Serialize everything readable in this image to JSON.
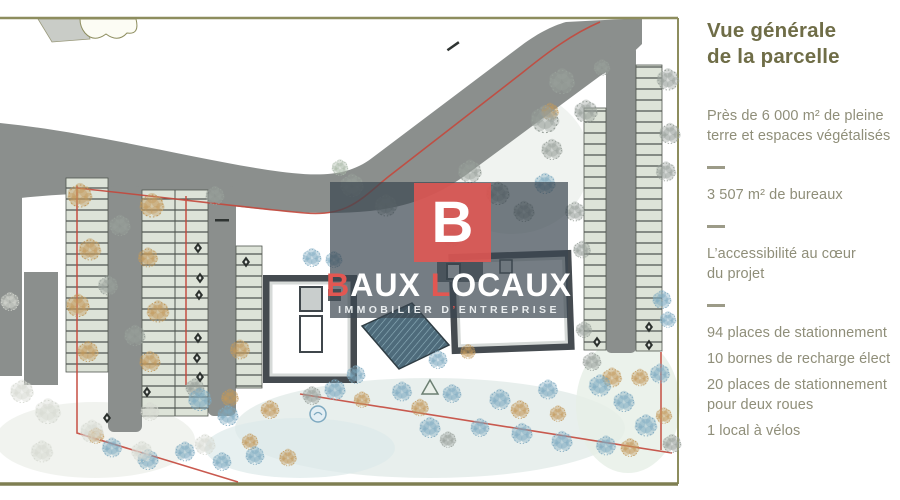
{
  "panel": {
    "title": "Vue générale\nde la parcelle",
    "items": [
      {
        "type": "text",
        "text": "Près de 6 000 m² de pleine\nterre et espaces végétalisés"
      },
      {
        "type": "divider"
      },
      {
        "type": "text",
        "text": "3 507 m² de bureaux"
      },
      {
        "type": "divider"
      },
      {
        "type": "text",
        "text": "L’accessibilité au cœur\ndu projet"
      },
      {
        "type": "divider"
      },
      {
        "type": "text",
        "text": "94 places de stationnement",
        "nowrap": true
      },
      {
        "type": "text",
        "text": "10 bornes de recharge élect",
        "nowrap": true
      },
      {
        "type": "text",
        "text": "20 places de stationnement\npour deux roues"
      },
      {
        "type": "text",
        "text": "1 local à vélos"
      }
    ],
    "colors": {
      "title": "#6f6d47",
      "body": "#8f8e79",
      "divider": "#9c9b88"
    }
  },
  "watermark": {
    "logo_letter": "B",
    "brand": [
      {
        "t": "B",
        "red": true
      },
      {
        "t": "AUX",
        "red": false
      },
      {
        "t": " ",
        "red": false
      },
      {
        "t": "L",
        "red": true
      },
      {
        "t": "OCAUX",
        "red": false
      }
    ],
    "tagline": [
      {
        "t": "IMMOBILIER D",
        "red": false
      },
      {
        "t": "’",
        "red": true
      },
      {
        "t": "ENTREPRISE",
        "red": false
      }
    ],
    "colors": {
      "accent": "#e25752",
      "band": "rgba(58,70,80,0.70)",
      "text": "#ffffff"
    }
  },
  "site_plan": {
    "colors": {
      "road": "#8b8f8d",
      "stall": "#dde3d8",
      "stall_tick": "#4a504b",
      "building": "#454b50",
      "glass": "#4e6b7b",
      "boundary_red": "#c4483c",
      "frame_olive": "#8d8d5e",
      "lawn": "#e0eae7"
    },
    "palette": {
      "blue": "#7ea9c0",
      "tan": "#c2995a",
      "gray": "#98a09a",
      "pale": "#d7dad3",
      "sage": "#a9b8a8"
    },
    "trees": [
      {
        "x": 80,
        "y": 196,
        "s": 1.05,
        "c": "tan"
      },
      {
        "x": 90,
        "y": 250,
        "s": 0.95,
        "c": "tan"
      },
      {
        "x": 78,
        "y": 306,
        "s": 1,
        "c": "tan"
      },
      {
        "x": 88,
        "y": 352,
        "s": 0.9,
        "c": "tan"
      },
      {
        "x": 152,
        "y": 206,
        "s": 1.05,
        "c": "tan"
      },
      {
        "x": 148,
        "y": 258,
        "s": 0.85,
        "c": "tan"
      },
      {
        "x": 158,
        "y": 312,
        "s": 0.95,
        "c": "tan"
      },
      {
        "x": 150,
        "y": 362,
        "s": 0.9,
        "c": "tan"
      },
      {
        "x": 240,
        "y": 350,
        "s": 0.85,
        "c": "tan"
      },
      {
        "x": 230,
        "y": 398,
        "s": 0.75,
        "c": "tan"
      },
      {
        "x": 550,
        "y": 112,
        "s": 0.75,
        "c": "tan"
      },
      {
        "x": 270,
        "y": 410,
        "s": 0.8,
        "c": "tan"
      },
      {
        "x": 362,
        "y": 400,
        "s": 0.7,
        "c": "tan"
      },
      {
        "x": 420,
        "y": 408,
        "s": 0.75,
        "c": "tan"
      },
      {
        "x": 520,
        "y": 410,
        "s": 0.8,
        "c": "tan"
      },
      {
        "x": 558,
        "y": 414,
        "s": 0.7,
        "c": "tan"
      },
      {
        "x": 96,
        "y": 436,
        "s": 0.7,
        "c": "tan"
      },
      {
        "x": 250,
        "y": 442,
        "s": 0.7,
        "c": "tan"
      },
      {
        "x": 288,
        "y": 458,
        "s": 0.75,
        "c": "tan"
      },
      {
        "x": 640,
        "y": 378,
        "s": 0.75,
        "c": "tan"
      },
      {
        "x": 630,
        "y": 448,
        "s": 0.8,
        "c": "tan"
      },
      {
        "x": 664,
        "y": 416,
        "s": 0.7,
        "c": "tan"
      },
      {
        "x": 612,
        "y": 378,
        "s": 0.85,
        "c": "tan"
      },
      {
        "x": 468,
        "y": 352,
        "s": 0.65,
        "c": "tan"
      },
      {
        "x": 120,
        "y": 226,
        "s": 0.9,
        "c": "gray"
      },
      {
        "x": 108,
        "y": 286,
        "s": 0.85,
        "c": "gray"
      },
      {
        "x": 135,
        "y": 336,
        "s": 0.9,
        "c": "gray"
      },
      {
        "x": 215,
        "y": 196,
        "s": 0.8,
        "c": "gray"
      },
      {
        "x": 352,
        "y": 186,
        "s": 1,
        "c": "gray"
      },
      {
        "x": 386,
        "y": 206,
        "s": 0.95,
        "c": "gray"
      },
      {
        "x": 470,
        "y": 172,
        "s": 1,
        "c": "gray"
      },
      {
        "x": 545,
        "y": 120,
        "s": 1.2,
        "c": "gray"
      },
      {
        "x": 562,
        "y": 82,
        "s": 1.1,
        "c": "gray"
      },
      {
        "x": 586,
        "y": 112,
        "s": 1,
        "c": "gray"
      },
      {
        "x": 552,
        "y": 150,
        "s": 0.9,
        "c": "gray"
      },
      {
        "x": 498,
        "y": 194,
        "s": 1,
        "c": "gray"
      },
      {
        "x": 524,
        "y": 212,
        "s": 0.9,
        "c": "gray"
      },
      {
        "x": 575,
        "y": 212,
        "s": 0.85,
        "c": "gray"
      },
      {
        "x": 668,
        "y": 80,
        "s": 0.95,
        "c": "gray"
      },
      {
        "x": 670,
        "y": 134,
        "s": 0.9,
        "c": "gray"
      },
      {
        "x": 666,
        "y": 172,
        "s": 0.85,
        "c": "gray"
      },
      {
        "x": 602,
        "y": 68,
        "s": 0.7,
        "c": "gray"
      },
      {
        "x": 582,
        "y": 250,
        "s": 0.75,
        "c": "gray"
      },
      {
        "x": 584,
        "y": 330,
        "s": 0.7,
        "c": "gray"
      },
      {
        "x": 312,
        "y": 396,
        "s": 0.8,
        "c": "gray"
      },
      {
        "x": 448,
        "y": 440,
        "s": 0.7,
        "c": "gray"
      },
      {
        "x": 195,
        "y": 388,
        "s": 0.8,
        "c": "gray"
      },
      {
        "x": 592,
        "y": 362,
        "s": 0.8,
        "c": "gray"
      },
      {
        "x": 672,
        "y": 444,
        "s": 0.8,
        "c": "gray"
      },
      {
        "x": 340,
        "y": 168,
        "s": 0.7,
        "c": "sage"
      },
      {
        "x": 545,
        "y": 184,
        "s": 0.9,
        "c": "blue"
      },
      {
        "x": 312,
        "y": 258,
        "s": 0.8,
        "c": "blue"
      },
      {
        "x": 334,
        "y": 260,
        "s": 0.72,
        "c": "blue"
      },
      {
        "x": 452,
        "y": 238,
        "s": 0.78,
        "c": "blue"
      },
      {
        "x": 438,
        "y": 360,
        "s": 0.8,
        "c": "blue"
      },
      {
        "x": 335,
        "y": 390,
        "s": 0.9,
        "c": "blue"
      },
      {
        "x": 356,
        "y": 375,
        "s": 0.8,
        "c": "blue"
      },
      {
        "x": 402,
        "y": 392,
        "s": 0.85,
        "c": "blue"
      },
      {
        "x": 430,
        "y": 428,
        "s": 0.9,
        "c": "blue"
      },
      {
        "x": 452,
        "y": 394,
        "s": 0.8,
        "c": "blue"
      },
      {
        "x": 500,
        "y": 400,
        "s": 0.9,
        "c": "blue"
      },
      {
        "x": 522,
        "y": 434,
        "s": 0.9,
        "c": "blue"
      },
      {
        "x": 548,
        "y": 390,
        "s": 0.85,
        "c": "blue"
      },
      {
        "x": 562,
        "y": 442,
        "s": 0.9,
        "c": "blue"
      },
      {
        "x": 480,
        "y": 428,
        "s": 0.8,
        "c": "blue"
      },
      {
        "x": 112,
        "y": 448,
        "s": 0.85,
        "c": "blue"
      },
      {
        "x": 148,
        "y": 460,
        "s": 0.9,
        "c": "blue"
      },
      {
        "x": 185,
        "y": 452,
        "s": 0.85,
        "c": "blue"
      },
      {
        "x": 222,
        "y": 462,
        "s": 0.8,
        "c": "blue"
      },
      {
        "x": 255,
        "y": 456,
        "s": 0.8,
        "c": "blue"
      },
      {
        "x": 200,
        "y": 400,
        "s": 1,
        "c": "blue"
      },
      {
        "x": 228,
        "y": 416,
        "s": 0.9,
        "c": "blue"
      },
      {
        "x": 600,
        "y": 386,
        "s": 0.95,
        "c": "blue"
      },
      {
        "x": 624,
        "y": 402,
        "s": 0.9,
        "c": "blue"
      },
      {
        "x": 646,
        "y": 426,
        "s": 0.95,
        "c": "blue"
      },
      {
        "x": 606,
        "y": 446,
        "s": 0.85,
        "c": "blue"
      },
      {
        "x": 660,
        "y": 374,
        "s": 0.85,
        "c": "blue"
      },
      {
        "x": 662,
        "y": 300,
        "s": 0.8,
        "c": "blue"
      },
      {
        "x": 668,
        "y": 320,
        "s": 0.7,
        "c": "blue"
      },
      {
        "x": 22,
        "y": 392,
        "s": 1,
        "c": "pale"
      },
      {
        "x": 48,
        "y": 412,
        "s": 1.1,
        "c": "pale"
      },
      {
        "x": 92,
        "y": 432,
        "s": 1,
        "c": "pale"
      },
      {
        "x": 142,
        "y": 452,
        "s": 0.9,
        "c": "pale"
      },
      {
        "x": 42,
        "y": 452,
        "s": 0.95,
        "c": "pale"
      },
      {
        "x": 10,
        "y": 302,
        "s": 0.8,
        "c": "pale"
      },
      {
        "x": 150,
        "y": 412,
        "s": 0.8,
        "c": "pale"
      },
      {
        "x": 205,
        "y": 445,
        "s": 0.9,
        "c": "pale"
      }
    ],
    "stall_markers": [
      {
        "x": 198,
        "y": 248
      },
      {
        "x": 200,
        "y": 278
      },
      {
        "x": 199,
        "y": 295
      },
      {
        "x": 198,
        "y": 338
      },
      {
        "x": 197,
        "y": 358
      },
      {
        "x": 200,
        "y": 377
      },
      {
        "x": 246,
        "y": 262
      },
      {
        "x": 107,
        "y": 418
      },
      {
        "x": 597,
        "y": 342
      },
      {
        "x": 649,
        "y": 327
      },
      {
        "x": 649,
        "y": 345
      },
      {
        "x": 147,
        "y": 392
      }
    ]
  }
}
